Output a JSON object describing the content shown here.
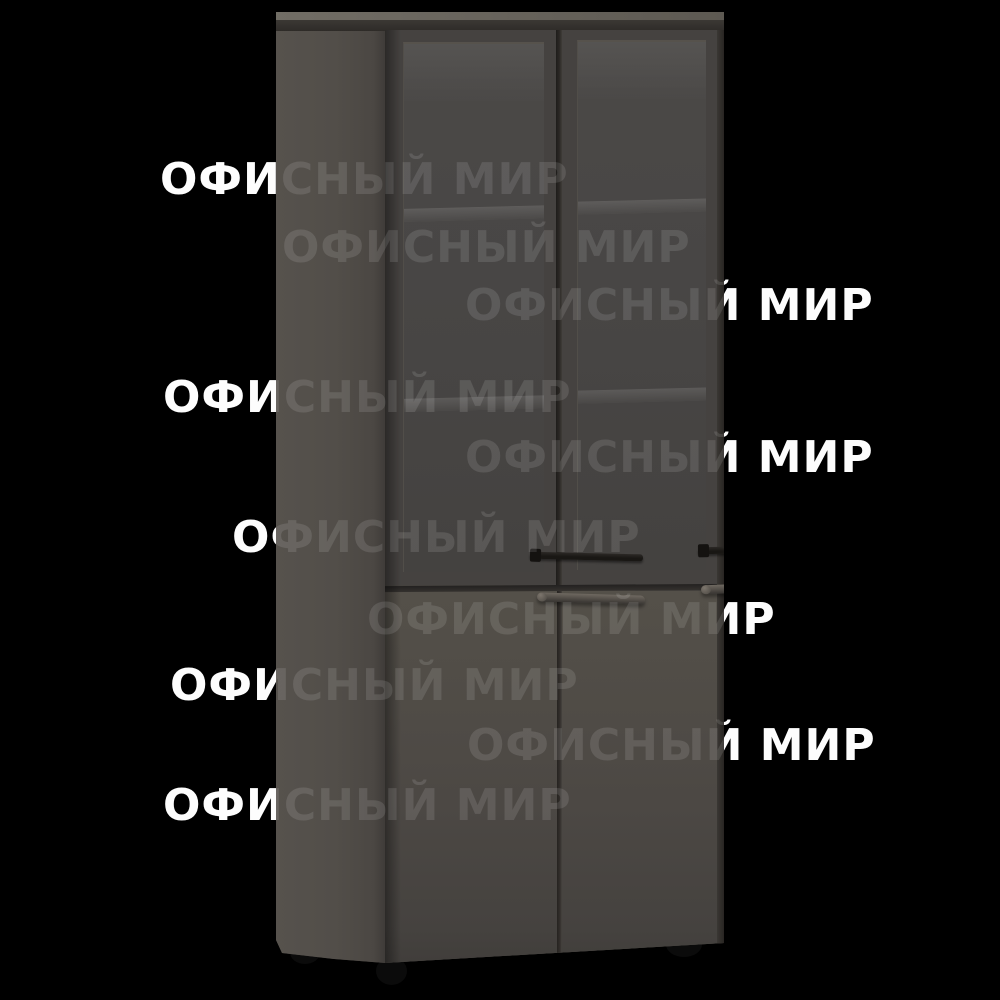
{
  "image": {
    "kind": "product-photo",
    "subject": "tall office cabinet with glass upper doors and solid lower doors, dark wenge finish, black background",
    "background_color": "#000000"
  },
  "watermark": {
    "text": "ОФИСНЫЙ МИР",
    "color_bright": "#fdfdfd",
    "overlay_opacity": 0.115,
    "rows": [
      {
        "text": "ОФИСНЫЙ МИР",
        "x": 160,
        "y": 158
      },
      {
        "text": "ОФИСНЫЙ МИР",
        "x": 282,
        "y": 226
      },
      {
        "text": "ОФИСНЫЙ МИР",
        "x": 465,
        "y": 284
      },
      {
        "text": "ОФИСНЫЙ МИР",
        "x": 163,
        "y": 376
      },
      {
        "text": "ОФИСНЫЙ МИР",
        "x": 465,
        "y": 436
      },
      {
        "text": "ОФИСНЫЙ МИР",
        "x": 232,
        "y": 516
      },
      {
        "text": "ОФИСНЫЙ МИР",
        "x": 367,
        "y": 598
      },
      {
        "text": "ОФИСНЫЙ МИР",
        "x": 170,
        "y": 664
      },
      {
        "text": "ОФИСНЫЙ МИР",
        "x": 467,
        "y": 724
      },
      {
        "text": "ОФИСНЫЙ МИР",
        "x": 163,
        "y": 784
      }
    ]
  },
  "product": {
    "name": "office-cabinet",
    "features": {
      "upper_section": "two framed glass doors with two visible shelves",
      "lower_section": "two solid doors",
      "handles": "horizontal bar handles, centered on each door",
      "feet": "three visible round black feet"
    },
    "colors": {
      "background": "#000000",
      "body": "#524e49",
      "front": "#45423e",
      "door_frame": "#454240",
      "glass": "#484645",
      "top_edge": "#2e2b28",
      "divider": "#2a2724",
      "handle_dark": "#191714",
      "handle_light": "#6f6961",
      "feet": "#0b0b0b",
      "watermark_bright": "#fdfdfd"
    }
  }
}
